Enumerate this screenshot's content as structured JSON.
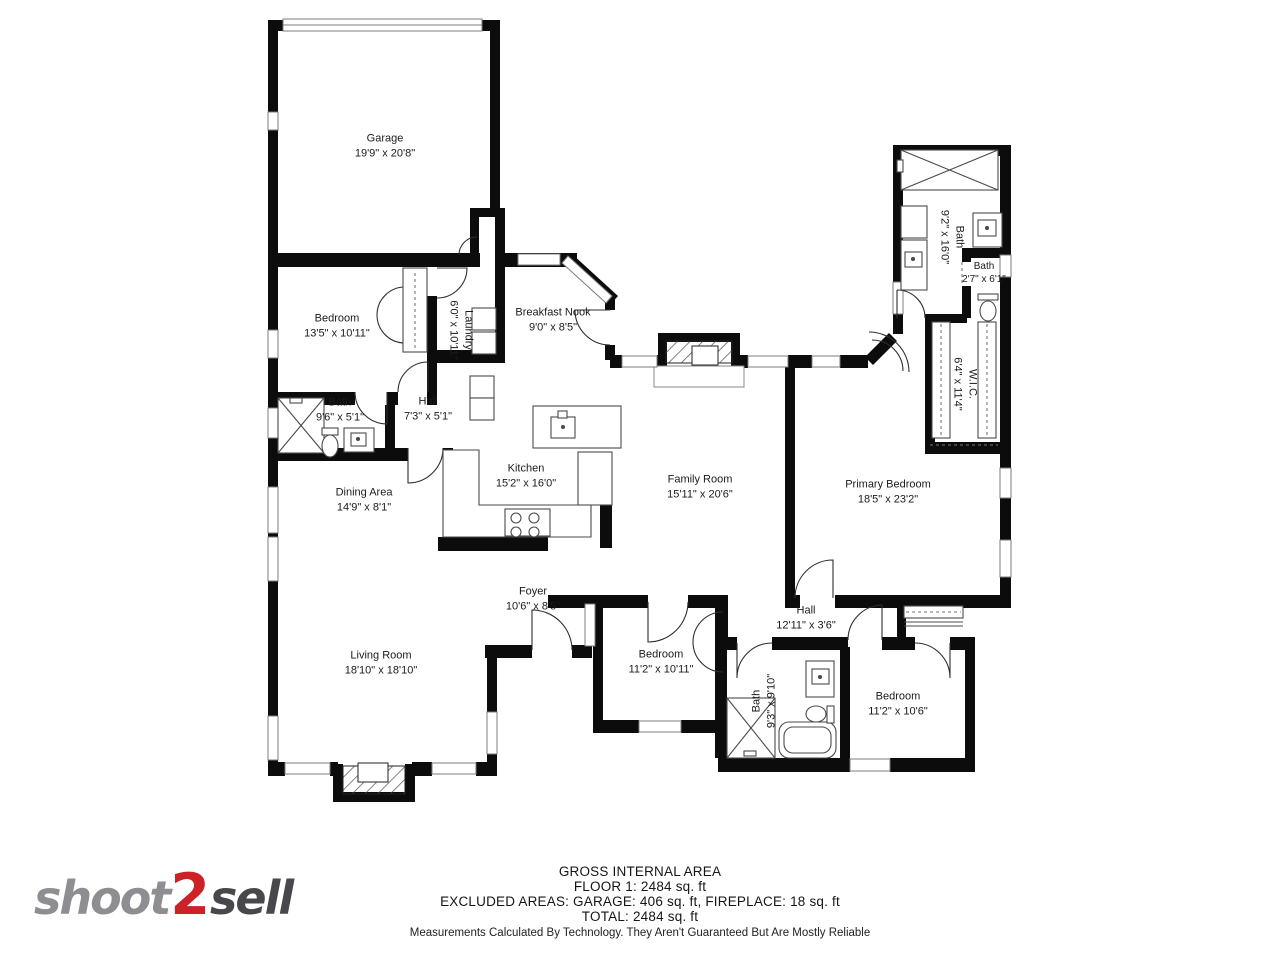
{
  "logo": {
    "part1": "shoot",
    "part2": "2",
    "part3": "sell"
  },
  "footer": {
    "line1": "GROSS INTERNAL AREA",
    "line2": "FLOOR 1: 2484 sq. ft",
    "line3": "EXCLUDED AREAS: GARAGE: 406 sq. ft, FIREPLACE: 18 sq. ft",
    "line4": "TOTAL: 2484 sq. ft",
    "disclaimer": "Measurements Calculated By Technology. They Aren't Guaranteed But Are Mostly Reliable"
  },
  "rooms": {
    "garage": {
      "name": "Garage",
      "dims": "19'9\" x 20'8\""
    },
    "bedroom1": {
      "name": "Bedroom",
      "dims": "13'5\" x 10'11\""
    },
    "laundry": {
      "name": "Laundry",
      "dims": "6'0\" x 10'11\""
    },
    "breakfast": {
      "name": "Breakfast Nook",
      "dims": "9'0\" x 8'5\""
    },
    "bath1": {
      "name": "Bath",
      "dims": "9'6\" x 5'1\""
    },
    "hall1": {
      "name": "Hall",
      "dims": "7'3\" x 5'1\""
    },
    "kitchen": {
      "name": "Kitchen",
      "dims": "15'2\" x 16'0\""
    },
    "family": {
      "name": "Family Room",
      "dims": "15'11\" x 20'6\""
    },
    "dining": {
      "name": "Dining Area",
      "dims": "14'9\" x 8'1\""
    },
    "primary": {
      "name": "Primary Bedroom",
      "dims": "18'5\" x 23'2\""
    },
    "bath_primary": {
      "name": "Bath",
      "dims": "9'2\" x 16'0\""
    },
    "bath_small": {
      "name": "Bath",
      "dims": "2'7\" x 6'1\""
    },
    "wic": {
      "name": "W.I.C.",
      "dims": "6'4\" x 11'4\""
    },
    "living": {
      "name": "Living Room",
      "dims": "18'10\" x 18'10\""
    },
    "foyer": {
      "name": "Foyer",
      "dims": "10'6\" x 8'5\""
    },
    "hall2": {
      "name": "Hall",
      "dims": "12'11\" x 3'6\""
    },
    "bedroom2": {
      "name": "Bedroom",
      "dims": "11'2\" x 10'11\""
    },
    "bath2": {
      "name": "Bath",
      "dims": "9'3\" x 9'10\""
    },
    "bedroom3": {
      "name": "Bedroom",
      "dims": "11'2\" x 10'6\""
    }
  },
  "colors": {
    "wall": "#0c0c0c",
    "accent_red": "#cc2127",
    "logo_gray": "#8d8d92",
    "logo_dark": "#47474c"
  }
}
